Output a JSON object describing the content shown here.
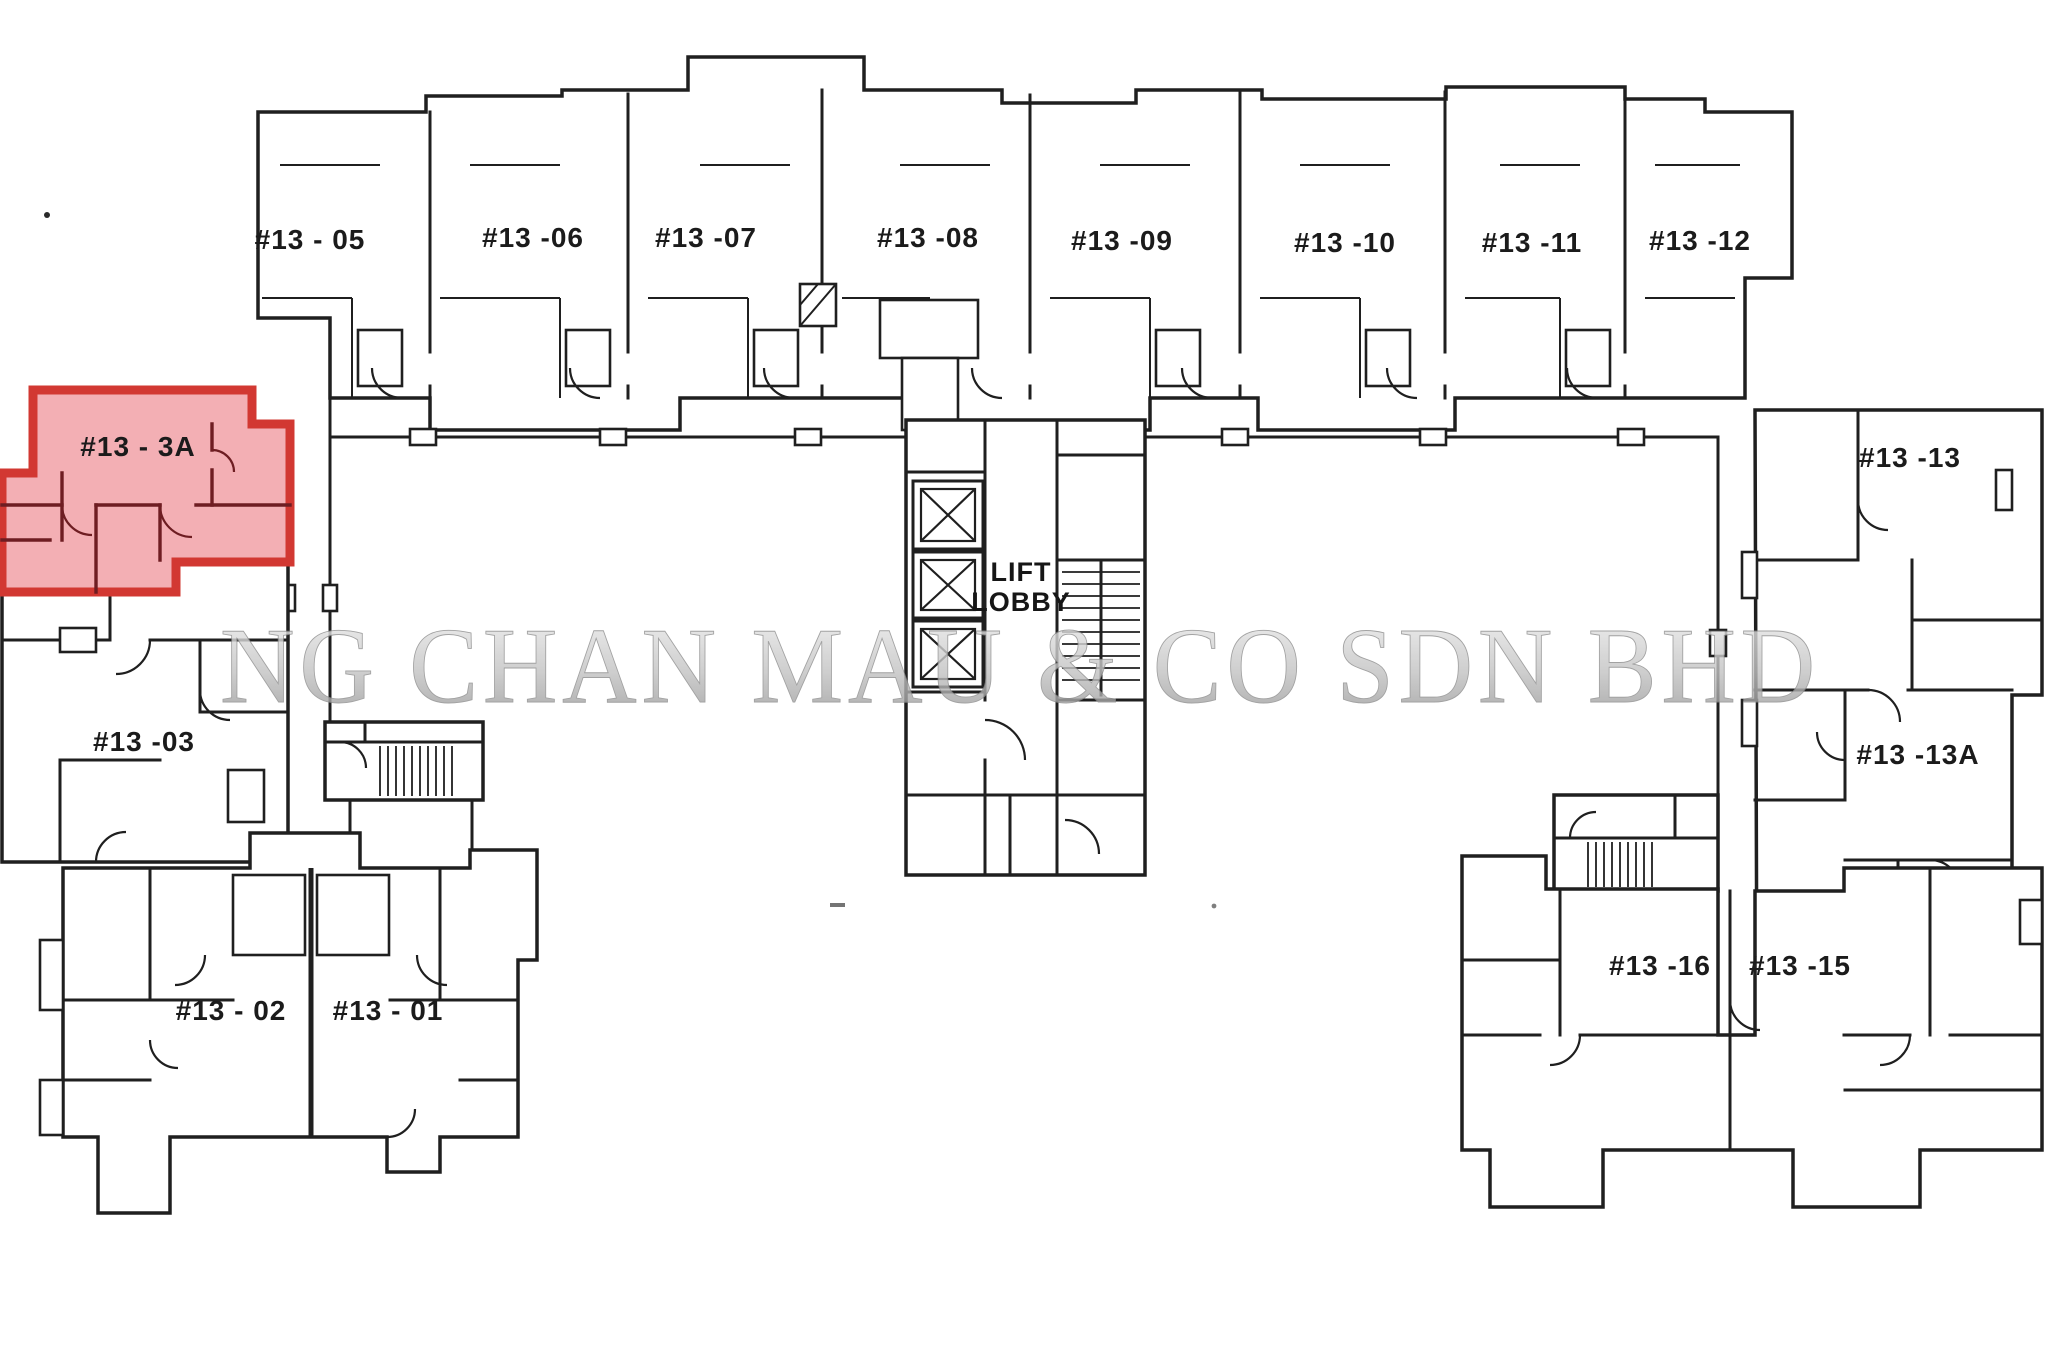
{
  "plan": {
    "floor_prefix": "#13",
    "units": [
      {
        "id": "13-05",
        "label": "#13 - 05",
        "highlighted": false
      },
      {
        "id": "13-06",
        "label": "#13 -06",
        "highlighted": false
      },
      {
        "id": "13-07",
        "label": "#13 -07",
        "highlighted": false
      },
      {
        "id": "13-08",
        "label": "#13 -08",
        "highlighted": false
      },
      {
        "id": "13-09",
        "label": "#13 -09",
        "highlighted": false
      },
      {
        "id": "13-10",
        "label": "#13 -10",
        "highlighted": false
      },
      {
        "id": "13-11",
        "label": "#13 -11",
        "highlighted": false
      },
      {
        "id": "13-12",
        "label": "#13 -12",
        "highlighted": false
      },
      {
        "id": "13-3A",
        "label": "#13 - 3A",
        "highlighted": true
      },
      {
        "id": "13-13",
        "label": "#13 -13",
        "highlighted": false
      },
      {
        "id": "13-03",
        "label": "#13 -03",
        "highlighted": false
      },
      {
        "id": "13-13A",
        "label": "#13 -13A",
        "highlighted": false
      },
      {
        "id": "13-02",
        "label": "#13 - 02",
        "highlighted": false
      },
      {
        "id": "13-01",
        "label": "#13 - 01",
        "highlighted": false
      },
      {
        "id": "13-16",
        "label": "#13 -16",
        "highlighted": false
      },
      {
        "id": "13-15",
        "label": "#13 -15",
        "highlighted": false
      }
    ],
    "lift_lobby": {
      "line1": "LIFT",
      "line2": "LOBBY"
    }
  },
  "watermark": {
    "text": "NG CHAN MAU & CO SDN BHD"
  },
  "colors": {
    "background": "#ffffff",
    "wall": "#1f1f1f",
    "highlight_fill": "#f0999f",
    "highlight_border": "#d23832",
    "highlight_wall": "#6e1d22",
    "watermark_gray": "#bdbdbd",
    "label_ink": "#1b1b1b"
  }
}
